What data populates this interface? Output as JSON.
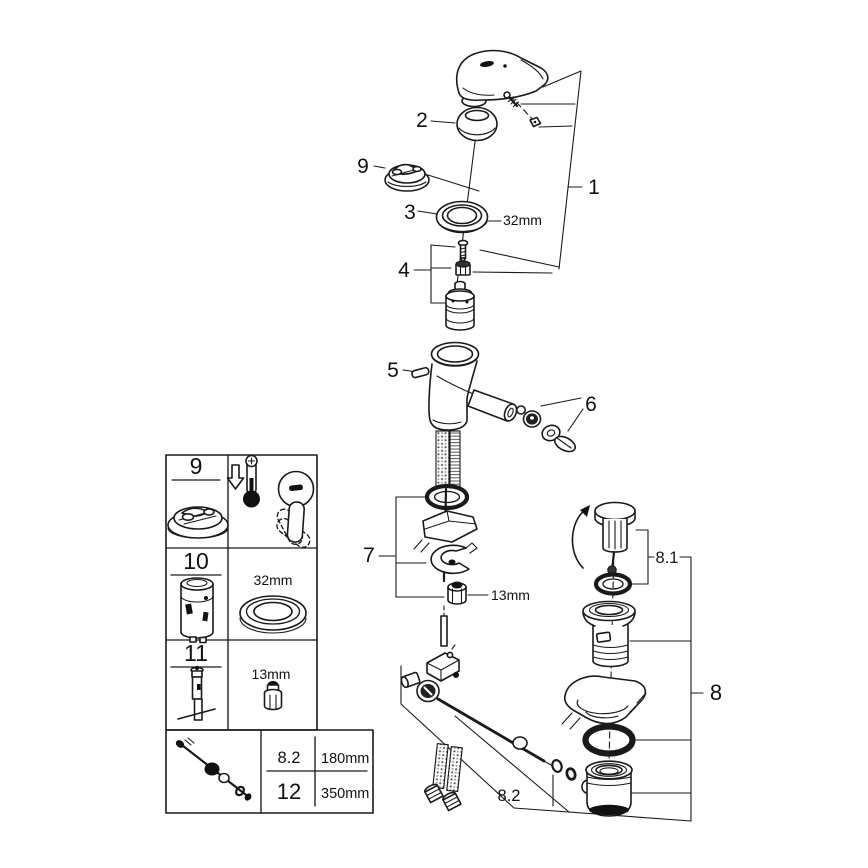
{
  "callouts": {
    "c1": "1",
    "c2": "2",
    "c3": "3",
    "c4": "4",
    "c5": "5",
    "c6": "6",
    "c7": "7",
    "c8": "8",
    "c8_1": "8.1",
    "c8_2": "8.2",
    "c9": "9",
    "dim_32mm": "32mm",
    "dim_13mm": "13mm"
  },
  "table": {
    "rows": [
      {
        "id": "9"
      },
      {
        "id": "10",
        "dim": "32mm"
      },
      {
        "id": "11",
        "dim": "13mm"
      }
    ],
    "size_table": {
      "r1_id": "8.2",
      "r1_len": "180mm",
      "r2_id": "12",
      "r2_len": "350mm"
    }
  },
  "icons": {
    "thermometer": "thermometer-hot-icon",
    "arrow_down": "arrow-down-icon",
    "rotate_arrow": "rotate-arrow-icon",
    "lever": "lever-positions-icon"
  },
  "colors": {
    "line": "#1a1a1a",
    "background": "#ffffff",
    "ink": "#111111"
  }
}
